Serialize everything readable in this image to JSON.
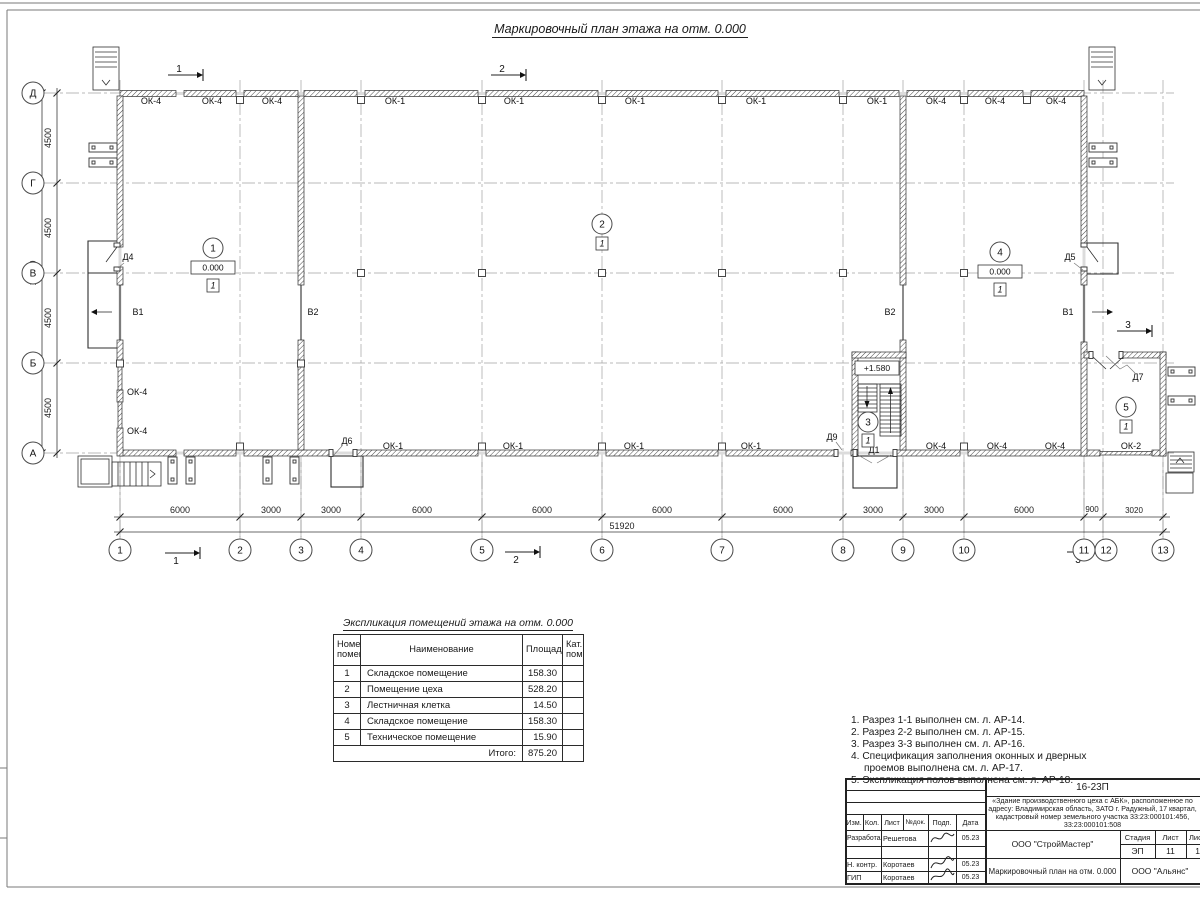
{
  "sheet": {
    "title": "Маркировочный план этажа на отм. 0.000"
  },
  "plan": {
    "axes_bottom": [
      "1",
      "2",
      "3",
      "4",
      "5",
      "6",
      "7",
      "8",
      "9",
      "10",
      "11",
      "12",
      "13"
    ],
    "axes_left": [
      "Д",
      "Г",
      "В",
      "Б",
      "А"
    ],
    "dims_bottom": [
      "6000",
      "3000",
      "3000",
      "6000",
      "6000",
      "6000",
      "6000",
      "3000",
      "3000",
      "6000",
      "900",
      "3020"
    ],
    "dim_total_bottom": "51920",
    "dims_left": [
      "4500",
      "4500",
      "4500",
      "4500"
    ],
    "dim_total_left": "18000",
    "windows_top": [
      "ОК-4",
      "ОК-4",
      "ОК-4",
      "ОК-1",
      "ОК-1",
      "ОК-1",
      "ОК-1",
      "ОК-1",
      "ОК-4",
      "ОК-4",
      "ОК-4"
    ],
    "windows_bottom": [
      "ОК-1",
      "ОК-1",
      "ОК-1",
      "ОК-1",
      "ОК-4",
      "ОК-4",
      "ОК-4",
      "ОК-2"
    ],
    "windows_left": [
      "ОК-4",
      "ОК-4"
    ],
    "gates": [
      "В1",
      "В2",
      "В2",
      "В1"
    ],
    "doors": {
      "d1": "Д1",
      "d4": "Д4",
      "d5": "Д5",
      "d6": "Д6",
      "d7": "Д7",
      "d9": "Д9"
    },
    "rooms": [
      {
        "num": "1",
        "elev": "0.000",
        "floor": "1"
      },
      {
        "num": "2",
        "floor": "1"
      },
      {
        "num": "3",
        "floor": "1"
      },
      {
        "num": "4",
        "elev": "0.000",
        "floor": "1"
      },
      {
        "num": "5",
        "floor": "1"
      }
    ],
    "landing_elev": "+1.580",
    "sections": {
      "one": "1",
      "two": "2",
      "three": "3"
    }
  },
  "table": {
    "title": "Экспликация помещений этажа на отм. 0.000",
    "headers": {
      "num": "Номер\nпомещ.",
      "name": "Наименование",
      "area": "Площадь",
      "cat": "Кат.\nпом."
    },
    "rows": [
      {
        "num": "1",
        "name": "Складское помещение",
        "area": "158.30"
      },
      {
        "num": "2",
        "name": "Помещение цеха",
        "area": "528.20"
      },
      {
        "num": "3",
        "name": "Лестничная клетка",
        "area": "14.50"
      },
      {
        "num": "4",
        "name": "Складское помещение",
        "area": "158.30"
      },
      {
        "num": "5",
        "name": "Техническое помещение",
        "area": "15.90"
      }
    ],
    "total_label": "Итого:",
    "total_value": "875.20"
  },
  "notes": {
    "items": [
      "1. Разрез 1-1 выполнен см. л. АР-14.",
      "2. Разрез 2-2 выполнен см. л. АР-15.",
      "3. Разрез 3-3 выполнен см. л. АР-16.",
      "4. Спецификация заполнения оконных и дверных",
      "проемов выполнена см. л. АР-17.",
      "5. Экспликация полов выполнена см. л. АР-18."
    ]
  },
  "titleblock": {
    "doc_number": "16-23П",
    "description": "«Здание производственного цеха с АБК», расположенное по адресу: Владимирская область, ЗАТО г. Радужный, 17 квартал, кадастровый номер земельного участка 33:23:000101:456, 33:23:000101:508",
    "cols": [
      "Изм.",
      "Кол.",
      "Лист",
      "№док.",
      "Подп.",
      "Дата"
    ],
    "rows": [
      {
        "role": "Разработал",
        "name": "Решетова",
        "date": "05.23"
      },
      {
        "role": "Н. контр.",
        "name": "Коротаев",
        "date": "05.23"
      },
      {
        "role": "ГИП",
        "name": "Коротаев",
        "date": "05.23"
      }
    ],
    "org1": "ООО \"СтройМастер\"",
    "stage_label": "Стадия",
    "sheet_label": "Лист",
    "sheets_label": "Листов",
    "stage": "ЭП",
    "sheet_num": "11",
    "sheets_num": "1",
    "drawing_title": "Маркировочный план на отм. 0.000",
    "org2": "ООО \"Альянс\""
  },
  "colors": {
    "line": "#2f2f2f",
    "grid": "#9a9a9a"
  }
}
